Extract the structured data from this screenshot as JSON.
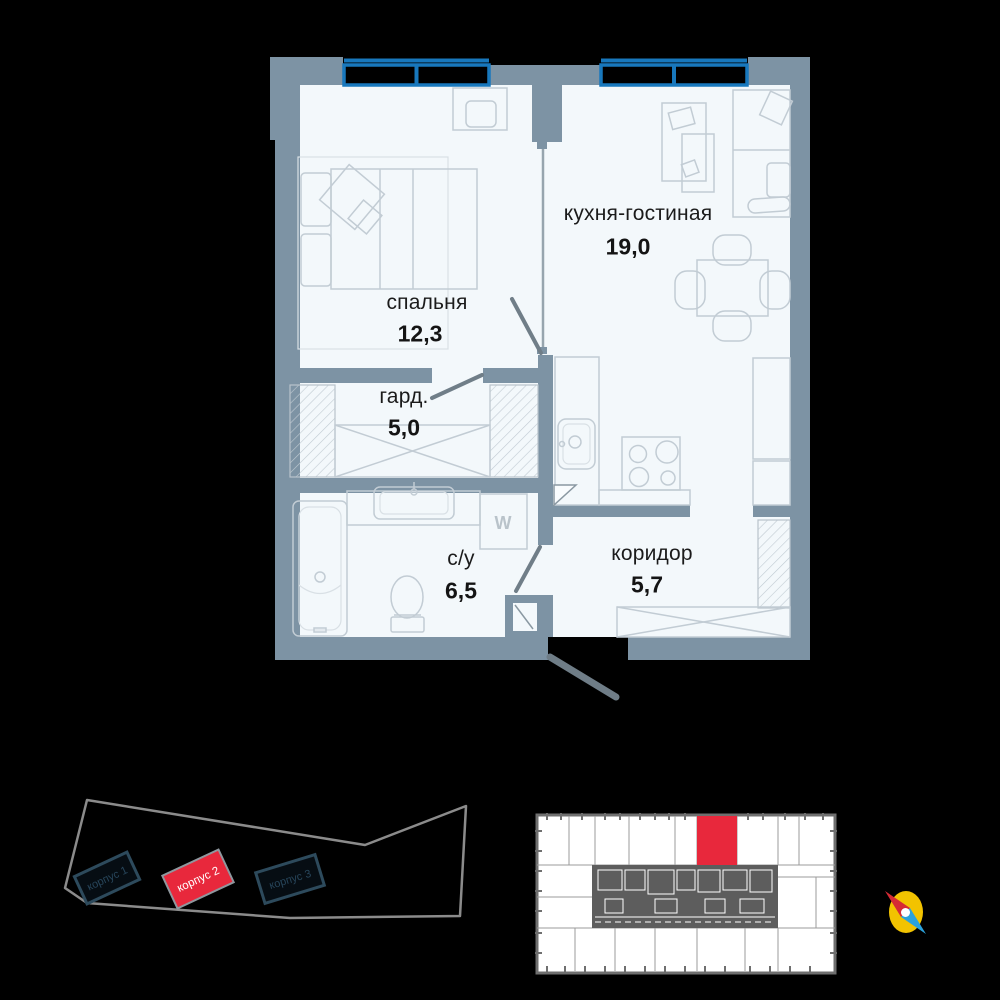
{
  "plan": {
    "rooms": [
      {
        "label": "кухня-гостиная",
        "area": "19,0"
      },
      {
        "label": "спальня",
        "area": "12,3"
      },
      {
        "label": "гард.",
        "area": "5,0"
      },
      {
        "label": "с/у",
        "area": "6,5"
      },
      {
        "label": "коридор",
        "area": "5,7"
      }
    ],
    "washer_label": "W",
    "colors": {
      "wall": "#7d93a4",
      "floor": "#f3f8fb",
      "window_frame": "#1878bd"
    }
  },
  "site_plan": {
    "buildings": [
      {
        "label": "корпус 1",
        "highlighted": false
      },
      {
        "label": "корпус 2",
        "highlighted": true
      },
      {
        "label": "корпус 3",
        "highlighted": false
      }
    ],
    "highlight_color": "#e8283c",
    "outline_color": "#8b8b8b",
    "building_color": "#2d4a5c"
  },
  "floor_plate": {
    "highlight_color": "#e8283c",
    "outline_color": "#6f6f6f",
    "core_color": "#5d5d5d"
  },
  "compass": {
    "disc_color": "#f2c300",
    "north_color": "#d52b35",
    "south_color": "#2ba2dc"
  }
}
